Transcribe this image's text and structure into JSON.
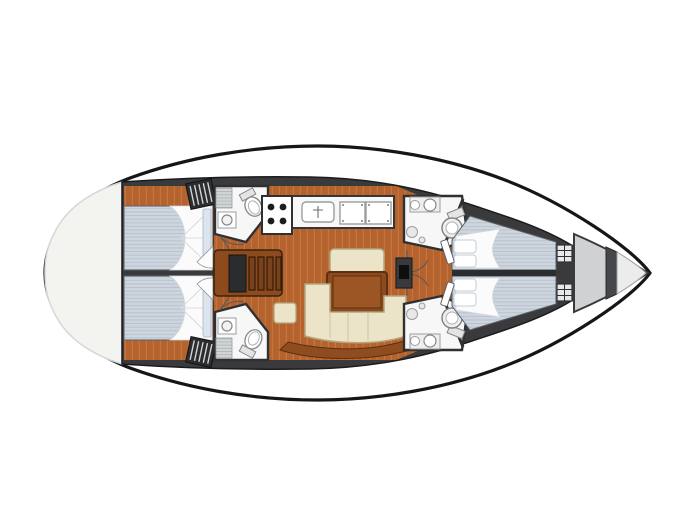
{
  "meta": {
    "diagram_type": "sailboat interior floor plan",
    "view": "top-down",
    "bow_direction": "right",
    "stern_direction": "left"
  },
  "palette": {
    "background": "#ffffff",
    "hull_outline": "#161616",
    "hull_fill": "#ffffff",
    "stern_deck": "#f3f3f0",
    "bow_deck": "#cfd1d2",
    "bow_tip": "#ececed",
    "interior_walls": "#3a3a3c",
    "floor": "#b4632e",
    "floor_stripe": "#c5753e",
    "mattress": "#cdd5de",
    "mattress_stripe": "#b7c1cc",
    "linen": "#fbfbfb",
    "pillow": "#dce5ee",
    "upholstery": "#ece4c8",
    "upholstery_edge": "#b1a67c",
    "wood_dark": "#8c4a1d",
    "wood_edge": "#5e2f10",
    "steps_wood": "#77421c",
    "fixture": "#f7f7f7",
    "fixture_rim": "#85888b",
    "shower_floor": "#d2d5d6",
    "shower_stripe": "#b2b6b8",
    "locker_dark": "#2c2d2f",
    "locker_stripe": "#d3d5d6",
    "hatch": "#e6e7e8",
    "step_band": "#8f4c20"
  },
  "features": {
    "stern_deck": {
      "name": "aft deck"
    },
    "aft_cabin_port": {
      "name": "aft double cabin (port)",
      "items": [
        "double berth",
        "duvet and pillows",
        "locker"
      ]
    },
    "aft_cabin_starboard": {
      "name": "aft double cabin (starboard)",
      "items": [
        "double berth",
        "duvet and pillows",
        "locker"
      ]
    },
    "aft_head_port": {
      "name": "aft head (port)",
      "items": [
        "toilet",
        "washbasin",
        "shower floor",
        "door"
      ]
    },
    "aft_head_starboard": {
      "name": "aft head (starboard)",
      "items": [
        "toilet",
        "washbasin",
        "shower floor",
        "door"
      ]
    },
    "companionway": {
      "name": "companionway steps over engine box"
    },
    "galley": {
      "name": "galley",
      "items": [
        "four-burner stove",
        "sink",
        "worktop lockers"
      ]
    },
    "saloon": {
      "name": "saloon",
      "items": [
        "settee",
        "table",
        "U-shaped sofa",
        "stool"
      ]
    },
    "mast_post": {
      "name": "mast support cabinet"
    },
    "fwd_head_port": {
      "name": "forward head (port)",
      "items": [
        "toilet",
        "washbasin",
        "shower",
        "door"
      ]
    },
    "fwd_head_starboard": {
      "name": "forward head (starboard)",
      "items": [
        "toilet",
        "washbasin",
        "shower",
        "door"
      ]
    },
    "forward_cabin_port": {
      "name": "forward V-berth cabin (port)",
      "items": [
        "berth",
        "pillows",
        "door"
      ]
    },
    "forward_cabin_starboard": {
      "name": "forward V-berth cabin (starboard)",
      "items": [
        "berth",
        "pillows",
        "door"
      ]
    },
    "bow": {
      "name": "bow lockers",
      "items": [
        "bulkhead hatches",
        "chain locker",
        "foredeck"
      ]
    }
  }
}
